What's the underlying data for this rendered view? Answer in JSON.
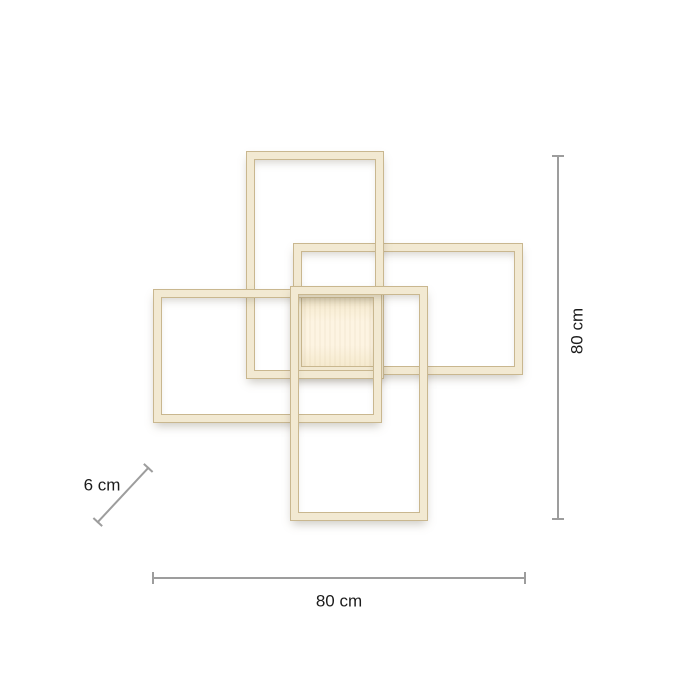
{
  "dimensions": {
    "height_label": "80 cm",
    "width_label": "80 cm",
    "depth_label": "6 cm"
  },
  "colors": {
    "frame_fill": "#f2e9d2",
    "frame_edge": "#c9b78f",
    "panel_glow": "#fdf4e2",
    "panel_edge_tint": "#f3e7c9",
    "dimension_line": "#9d9d9d",
    "label_text": "#1c1c1c",
    "background": "#ffffff"
  }
}
